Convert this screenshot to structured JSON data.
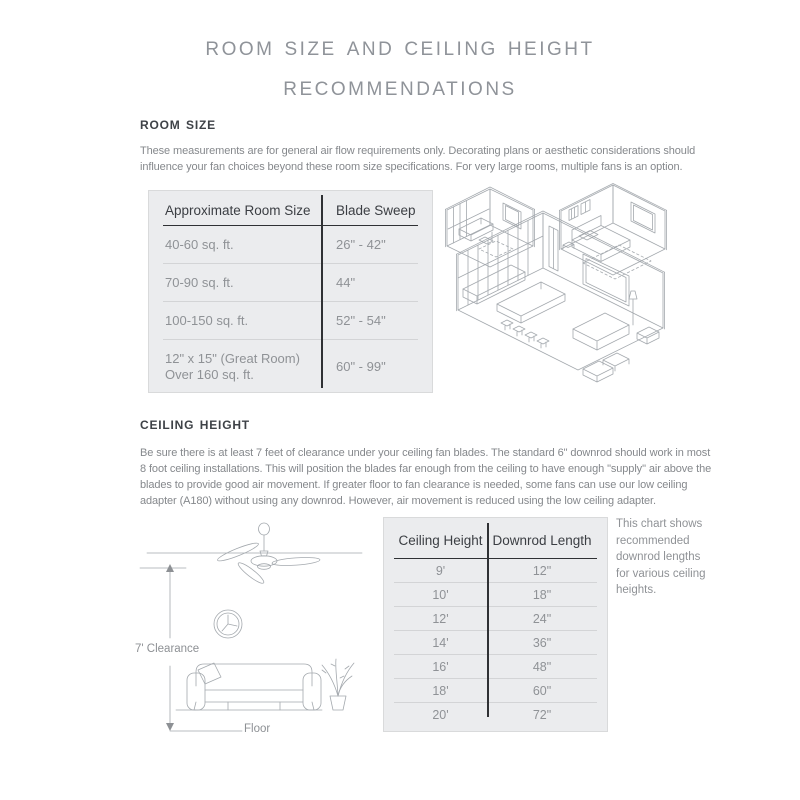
{
  "title": {
    "line1": "Room Size and Ceiling Height",
    "line2": "Recommendations"
  },
  "room_size": {
    "heading": "Room Size",
    "description": "These measurements are for general air flow requirements only. Decorating plans or aesthetic considerations should influence your fan choices beyond these room size specifications. For very large rooms, multiple fans is an option.",
    "table": {
      "col1_header": "Approximate Room Size",
      "col2_header": "Blade Sweep",
      "rows": [
        {
          "size": "40-60 sq. ft.",
          "sweep": "26\" - 42\""
        },
        {
          "size": "70-90 sq. ft.",
          "sweep": "44\""
        },
        {
          "size": "100-150 sq. ft.",
          "sweep": "52\" - 54\""
        },
        {
          "size": "12\" x 15\" (Great Room)\nOver 160 sq. ft.",
          "sweep": "60\" - 99\""
        }
      ]
    }
  },
  "ceiling_height": {
    "heading": "Ceiling Height",
    "description": "Be sure there is at least 7 feet of clearance under your ceiling fan blades. The standard 6\" downrod should work in most 8 foot ceiling installations. This will position the blades far enough from the ceiling to have enough \"supply\" air above the blades to provide good air movement. If greater floor to fan clearance is needed, some fans can use our low ceiling adapter (A180) without using any downrod. However, air movement is reduced using the low ceiling adapter.",
    "diagram": {
      "clearance_label": "7' Clearance",
      "floor_label": "Floor"
    },
    "table": {
      "col1_header": "Ceiling Height",
      "col2_header": "Downrod Length",
      "rows": [
        {
          "height": "9'",
          "downrod": "12\""
        },
        {
          "height": "10'",
          "downrod": "18\""
        },
        {
          "height": "12'",
          "downrod": "24\""
        },
        {
          "height": "14'",
          "downrod": "36\""
        },
        {
          "height": "16'",
          "downrod": "48\""
        },
        {
          "height": "18'",
          "downrod": "60\""
        },
        {
          "height": "20'",
          "downrod": "72\""
        }
      ]
    },
    "note": "This chart shows recommended downrod lengths for various ceiling heights."
  },
  "colors": {
    "title_gray": "#8f9399",
    "heading_dark": "#3e4247",
    "body_text": "#85888c",
    "table_background": "#ebecee",
    "table_border": "#d9dadb",
    "table_header_text": "#3b3e43",
    "table_cell_text": "#8f9296",
    "table_rule_dark": "#2f3134",
    "table_rule_light": "#d3d4d6",
    "illustration_stroke": "#a4a9ae"
  }
}
